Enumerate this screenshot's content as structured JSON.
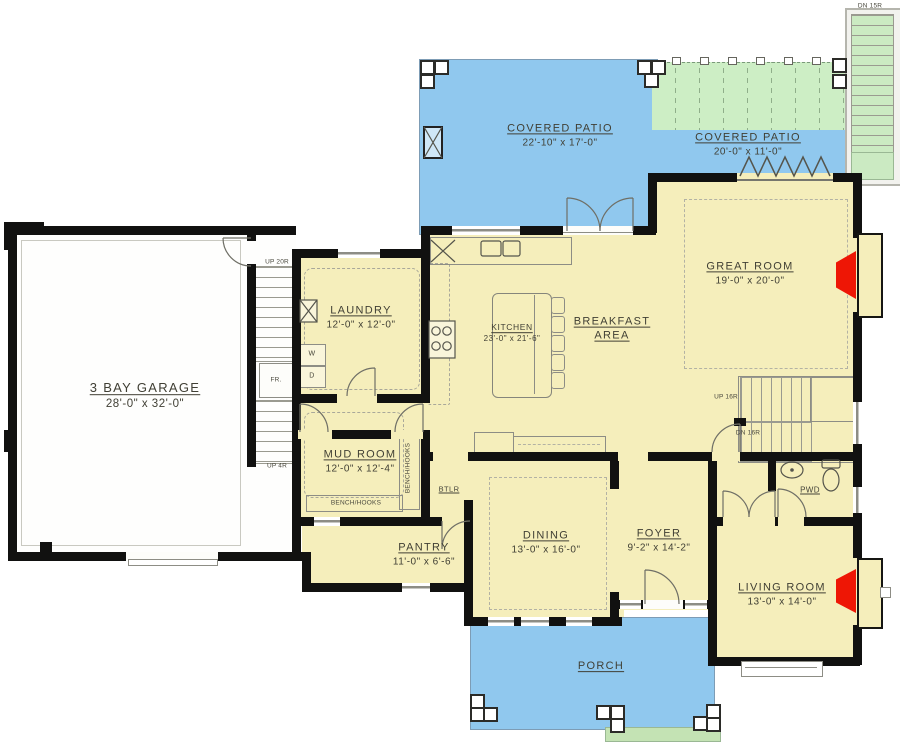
{
  "colors": {
    "floor": "#f5eebb",
    "patio_blue": "#90c8ee",
    "pergola_green": "#cdeec5",
    "outdoor_stair_green": "#cbeac2",
    "porch_steps_green": "#c4e3b4",
    "wall": "#111110",
    "fireplace_red": "#ee1605",
    "garage_floor": "#fefefd",
    "line_gray": "#8d8d85",
    "text": "#403f34"
  },
  "rooms": [
    {
      "id": "garage",
      "name": "3 BAY GARAGE",
      "dims": "28'-0\" x 32'-0\""
    },
    {
      "id": "laundry",
      "name": "LAUNDRY",
      "dims": "12'-0\" x 12'-0\""
    },
    {
      "id": "mudroom",
      "name": "MUD ROOM",
      "dims": "12'-0\" x 12'-4\""
    },
    {
      "id": "kitchen",
      "name": "KITCHEN",
      "dims": "23'-0\" x 21'-6\""
    },
    {
      "id": "breakfast",
      "name": "BREAKFAST AREA",
      "dims": ""
    },
    {
      "id": "greatroom",
      "name": "GREAT ROOM",
      "dims": "19'-0\" x 20'-0\""
    },
    {
      "id": "pantry",
      "name": "PANTRY",
      "dims": "11'-0\" x 6'-6\""
    },
    {
      "id": "dining",
      "name": "DINING",
      "dims": "13'-0\" x 16'-0\""
    },
    {
      "id": "foyer",
      "name": "FOYER",
      "dims": "9'-2\" x 14'-2\""
    },
    {
      "id": "living",
      "name": "LIVING ROOM",
      "dims": "13'-0\" x 14'-0\""
    },
    {
      "id": "patio1",
      "name": "COVERED PATIO",
      "dims": "22'-10\" x 17'-0\""
    },
    {
      "id": "patio2",
      "name": "COVERED PATIO",
      "dims": "20'-0\" x 11'-0\""
    },
    {
      "id": "porch",
      "name": "PORCH",
      "dims": ""
    }
  ],
  "labels": {
    "pwd": "PWD",
    "btlr": "BTLR",
    "bench_hooks_side": "BENCH/HOOKS",
    "bench_hooks_bottom": "BENCH/HOOKS",
    "washer": "W",
    "dryer": "D",
    "fridge": "FR.",
    "stair_up20": "UP 20R",
    "stair_up4": "UP 4R",
    "stair_up16": "UP 16R",
    "stair_dn16": "DN 16R",
    "stair_dn15": "DN 15R"
  }
}
